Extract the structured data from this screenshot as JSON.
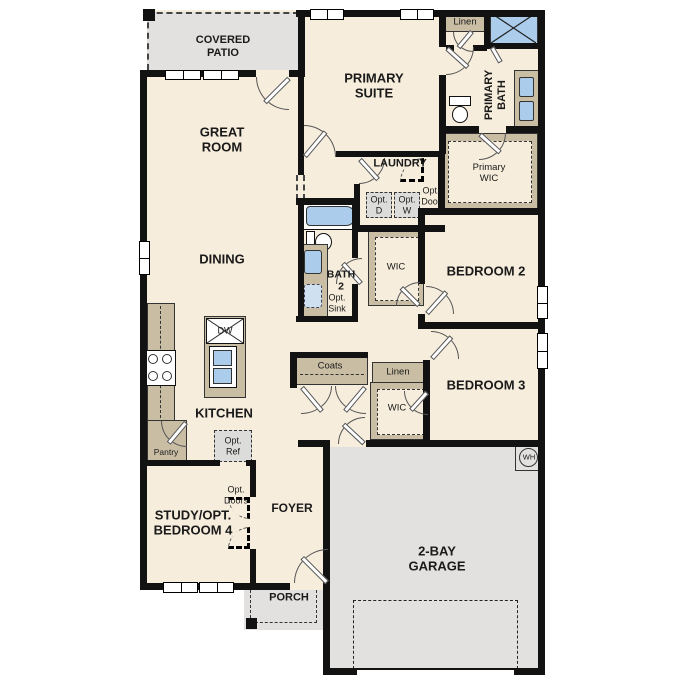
{
  "plan": {
    "rooms": {
      "covered_patio": "COVERED\nPATIO",
      "great_room": "GREAT\nROOM",
      "primary_suite": "PRIMARY\nSUITE",
      "primary_bath": "PRIMARY\nBATH",
      "primary_wic": "Primary\nWIC",
      "laundry": "LAUNDRY",
      "dining": "DINING",
      "bath_2": "BATH\n2",
      "bedroom_2": "BEDROOM 2",
      "bedroom_3": "BEDROOM 3",
      "kitchen": "KITCHEN",
      "study": "STUDY/OPT.\nBEDROOM 4",
      "foyer": "FOYER",
      "porch": "PORCH",
      "garage": "2-BAY\nGARAGE"
    },
    "closets": {
      "linen_upper": "Linen",
      "linen_hall": "Linen",
      "coats": "Coats",
      "pantry": "Pantry",
      "wic_2": "WIC",
      "wic_3": "WIC"
    },
    "options": {
      "opt_dryer": "Opt.\nD",
      "opt_washer": "Opt.\nW",
      "opt_door": "Opt.\nDoor",
      "opt_sink": "Opt.\nSink",
      "opt_ref": "Opt.\nRef",
      "opt_doors": "Opt.\nDoors"
    },
    "appliances": {
      "dishwasher": "DW",
      "water_heater": "WH"
    },
    "colors": {
      "floor": "#f6eddc",
      "outdoor": "#e2e1df",
      "cabinet": "#c9bda4",
      "fixture_blue": "#abccea",
      "optional_fill": "#dcdcda",
      "wall": "#121212"
    }
  }
}
